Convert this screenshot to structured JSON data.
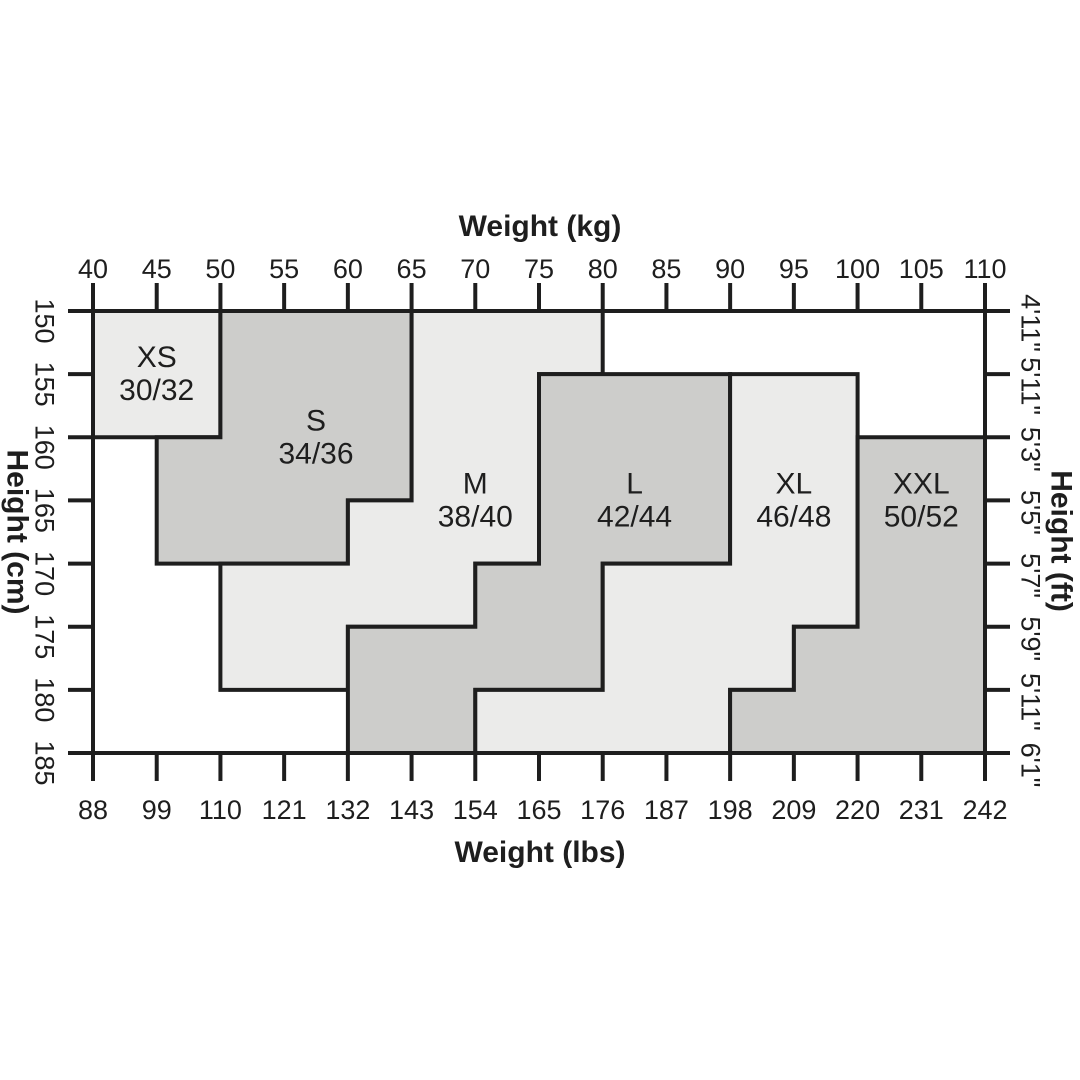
{
  "chart_data": {
    "type": "area",
    "subtype": "stepped-size-regions",
    "title": "Clothing size chart by weight and height",
    "grid": false,
    "plot": {
      "x_unit": "kg",
      "y_unit": "cm",
      "x_range_kg": [
        40,
        110
      ],
      "y_range_cm": [
        150,
        185
      ],
      "y_direction": "increases-downward"
    },
    "axes": {
      "top": {
        "title": "Weight (kg)",
        "values": [
          40,
          45,
          50,
          55,
          60,
          65,
          70,
          75,
          80,
          85,
          90,
          95,
          100,
          105,
          110
        ],
        "labels": [
          "40",
          "45",
          "50",
          "55",
          "60",
          "65",
          "70",
          "75",
          "80",
          "85",
          "90",
          "95",
          "100",
          "105",
          "110"
        ]
      },
      "bottom": {
        "title": "Weight (lbs)",
        "values": [
          40,
          45,
          50,
          55,
          60,
          65,
          70,
          75,
          80,
          85,
          90,
          95,
          100,
          105,
          110
        ],
        "labels": [
          "88",
          "99",
          "110",
          "121",
          "132",
          "143",
          "154",
          "165",
          "176",
          "187",
          "198",
          "209",
          "220",
          "231",
          "242"
        ]
      },
      "left": {
        "title": "Height (cm)",
        "values": [
          150,
          155,
          160,
          165,
          170,
          175,
          180,
          185
        ],
        "labels": [
          "150",
          "155",
          "160",
          "165",
          "170",
          "175",
          "180",
          "185"
        ]
      },
      "right": {
        "title": "Height (ft)",
        "values": [
          150,
          155,
          160,
          165,
          170,
          175,
          180,
          185
        ],
        "labels": [
          "4'11\"",
          "5'11\"",
          "5'3\"",
          "5'5\"",
          "5'7\"",
          "5'9\"",
          "5'11\"",
          "6'1\""
        ]
      }
    },
    "regions": [
      {
        "id": "xs",
        "label": "XS",
        "sub": "30/32",
        "shade": "light",
        "label_pos": [
          45,
          155
        ],
        "points": [
          [
            40,
            150
          ],
          [
            50,
            150
          ],
          [
            50,
            160
          ],
          [
            40,
            160
          ]
        ]
      },
      {
        "id": "s",
        "label": "S",
        "sub": "34/36",
        "shade": "dark",
        "label_pos": [
          57.5,
          160
        ],
        "points": [
          [
            50,
            150
          ],
          [
            65,
            150
          ],
          [
            65,
            165
          ],
          [
            60,
            165
          ],
          [
            60,
            170
          ],
          [
            45,
            170
          ],
          [
            45,
            160
          ],
          [
            50,
            160
          ]
        ]
      },
      {
        "id": "m",
        "label": "M",
        "sub": "38/40",
        "shade": "light",
        "label_pos": [
          70,
          165
        ],
        "points": [
          [
            65,
            150
          ],
          [
            80,
            150
          ],
          [
            80,
            155
          ],
          [
            75,
            155
          ],
          [
            75,
            170
          ],
          [
            70,
            170
          ],
          [
            70,
            175
          ],
          [
            60,
            175
          ],
          [
            60,
            180
          ],
          [
            50,
            180
          ],
          [
            50,
            170
          ],
          [
            60,
            170
          ],
          [
            60,
            165
          ],
          [
            65,
            165
          ]
        ]
      },
      {
        "id": "l",
        "label": "L",
        "sub": "42/44",
        "shade": "dark",
        "label_pos": [
          82.5,
          165
        ],
        "points": [
          [
            75,
            155
          ],
          [
            90,
            155
          ],
          [
            90,
            170
          ],
          [
            80,
            170
          ],
          [
            80,
            180
          ],
          [
            70,
            180
          ],
          [
            70,
            185
          ],
          [
            60,
            185
          ],
          [
            60,
            175
          ],
          [
            70,
            175
          ],
          [
            70,
            170
          ],
          [
            75,
            170
          ]
        ]
      },
      {
        "id": "xl",
        "label": "XL",
        "sub": "46/48",
        "shade": "light",
        "label_pos": [
          95,
          165
        ],
        "points": [
          [
            90,
            155
          ],
          [
            100,
            155
          ],
          [
            100,
            175
          ],
          [
            95,
            175
          ],
          [
            95,
            180
          ],
          [
            90,
            180
          ],
          [
            90,
            185
          ],
          [
            70,
            185
          ],
          [
            70,
            180
          ],
          [
            80,
            180
          ],
          [
            80,
            170
          ],
          [
            90,
            170
          ]
        ]
      },
      {
        "id": "xxl",
        "label": "XXL",
        "sub": "50/52",
        "shade": "dark",
        "label_pos": [
          105,
          165
        ],
        "points": [
          [
            100,
            160
          ],
          [
            110,
            160
          ],
          [
            110,
            185
          ],
          [
            90,
            185
          ],
          [
            90,
            180
          ],
          [
            95,
            180
          ],
          [
            95,
            175
          ],
          [
            100,
            175
          ]
        ]
      }
    ],
    "colors": {
      "light": "#ebebea",
      "dark": "#cdcdcb",
      "line": "#1e1e1e",
      "background": "#ffffff"
    }
  }
}
